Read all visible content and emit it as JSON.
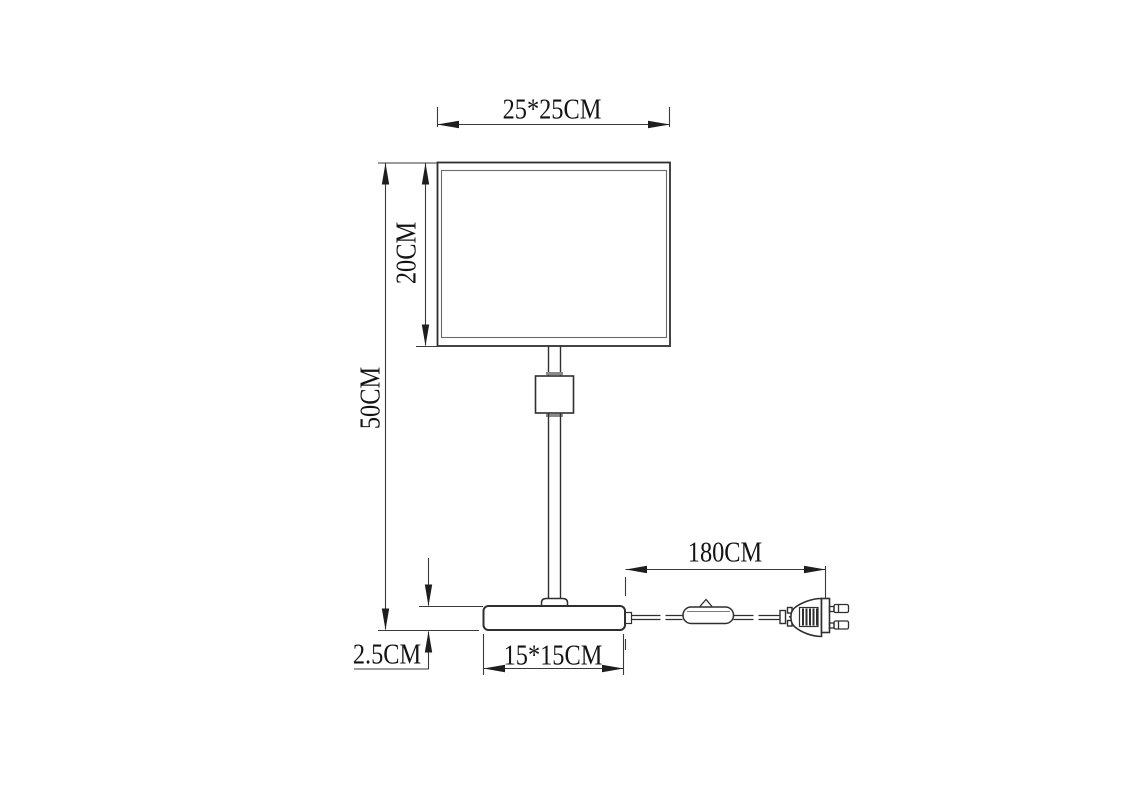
{
  "diagram": {
    "background": "#ffffff",
    "stroke_color": "#2f2f2f",
    "dimension_line_color": "#3a3a3a",
    "text_color": "#141414",
    "dimensions": {
      "shade_width": "25*25CM",
      "shade_height": "20CM",
      "total_height": "50CM",
      "base_height": "2.5CM",
      "base_size": "15*15CM",
      "cord_length": "180CM"
    }
  }
}
